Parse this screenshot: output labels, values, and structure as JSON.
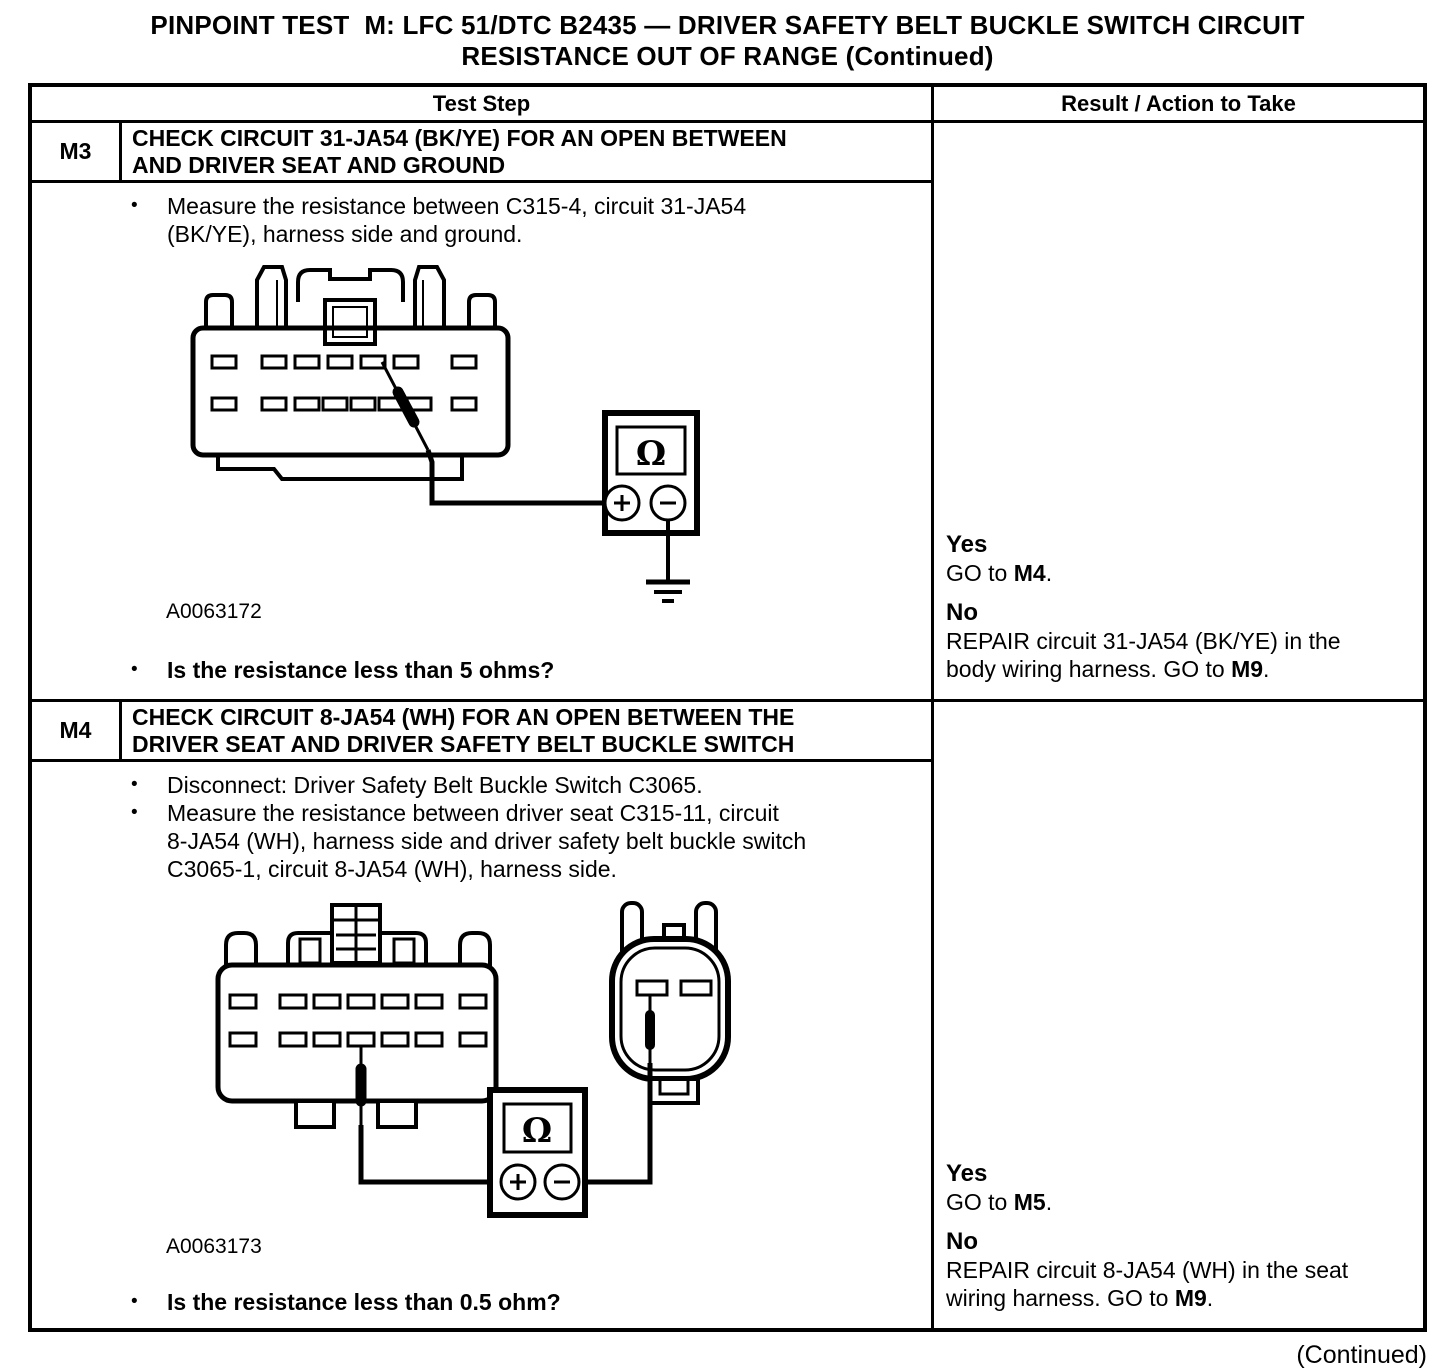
{
  "page": {
    "title": "PINPOINT TEST  M: LFC 51/DTC B2435 — DRIVER SAFETY BELT BUCKLE SWITCH CIRCUIT\nRESISTANCE OUT OF RANGE (Continued)",
    "continued": "(Continued)"
  },
  "table": {
    "header": {
      "test_step": "Test Step",
      "result": "Result / Action to Take"
    },
    "m3": {
      "id": "M3",
      "title": "CHECK CIRCUIT 31-JA54 (BK/YE) FOR AN OPEN BETWEEN\nAND DRIVER SEAT AND GROUND",
      "bullet1": "Measure the resistance between C315-4, circuit 31-JA54\n(BK/YE), harness side and ground.",
      "figure_id": "A0063172",
      "question": "Is the resistance less than 5 ohms?",
      "diagram": {
        "meter_symbol": "Ω"
      },
      "result": {
        "yes_label": "Yes",
        "yes_pre": "GO to ",
        "yes_bold": "M4",
        "yes_post": ".",
        "no_label": "No",
        "no_pre": "REPAIR circuit 31-JA54 (BK/YE) in the\nbody wiring harness. GO to ",
        "no_bold": "M9",
        "no_post": "."
      }
    },
    "m4": {
      "id": "M4",
      "title": "CHECK CIRCUIT 8-JA54 (WH) FOR AN OPEN BETWEEN THE\nDRIVER SEAT AND DRIVER SAFETY BELT BUCKLE SWITCH",
      "bullet1": "Disconnect: Driver Safety Belt Buckle Switch C3065.",
      "bullet2": "Measure the resistance between driver seat C315-11, circuit\n8-JA54 (WH), harness side and driver safety belt buckle switch\nC3065-1, circuit 8-JA54 (WH), harness side.",
      "figure_id": "A0063173",
      "question": "Is the resistance less than 0.5 ohm?",
      "diagram": {
        "meter_symbol": "Ω"
      },
      "result": {
        "yes_label": "Yes",
        "yes_pre": "GO to ",
        "yes_bold": "M5",
        "yes_post": ".",
        "no_label": "No",
        "no_pre": "REPAIR circuit 8-JA54 (WH) in the seat\nwiring harness. GO to ",
        "no_bold": "M9",
        "no_post": "."
      }
    }
  }
}
